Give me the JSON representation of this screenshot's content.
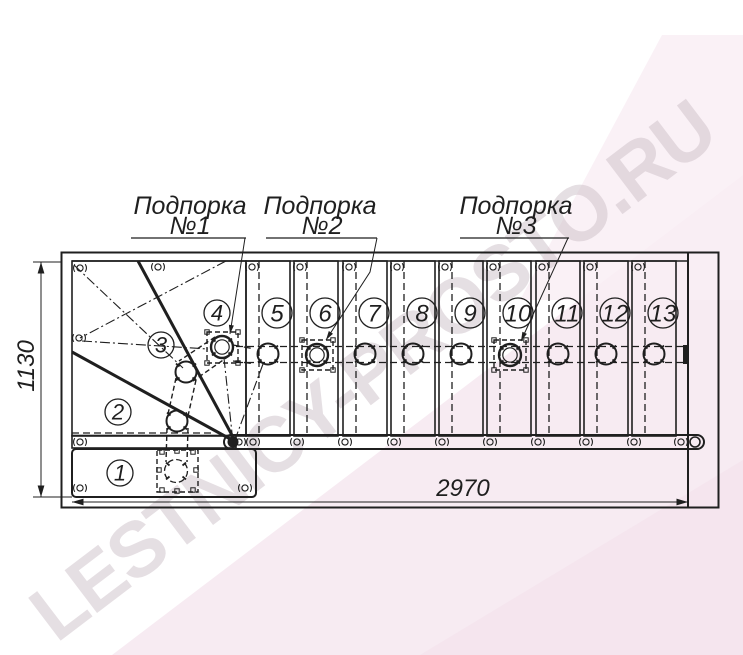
{
  "drawing": {
    "support_labels": [
      {
        "title": "Подпорка",
        "number": "№1"
      },
      {
        "title": "Подпорка",
        "number": "№2"
      },
      {
        "title": "Подпорка",
        "number": "№3"
      }
    ],
    "dimensions": {
      "length_mm": "2970",
      "width_mm": "1130"
    },
    "step_numbers": [
      "1",
      "2",
      "3",
      "4",
      "5",
      "6",
      "7",
      "8",
      "9",
      "10",
      "11",
      "12",
      "13"
    ]
  },
  "watermark": {
    "text": "LESTNICY-PROSTO.RU"
  },
  "icons": {
    "fastener-clip-icon": "small circle flanked by two arcs ( o )",
    "module-joint-icon": "circle with four radial tick nubs",
    "support-plate-icon": "dashed square with corner c-marks",
    "dimension-arrow-icon": "filled triangle arrowhead"
  },
  "colors": {
    "line": "#1f1f1f",
    "paper": "#ffffff",
    "pink_wash": "#f7ebf2",
    "pink_deep": "#f3e3ec",
    "watermark": "#cfc2ca"
  }
}
